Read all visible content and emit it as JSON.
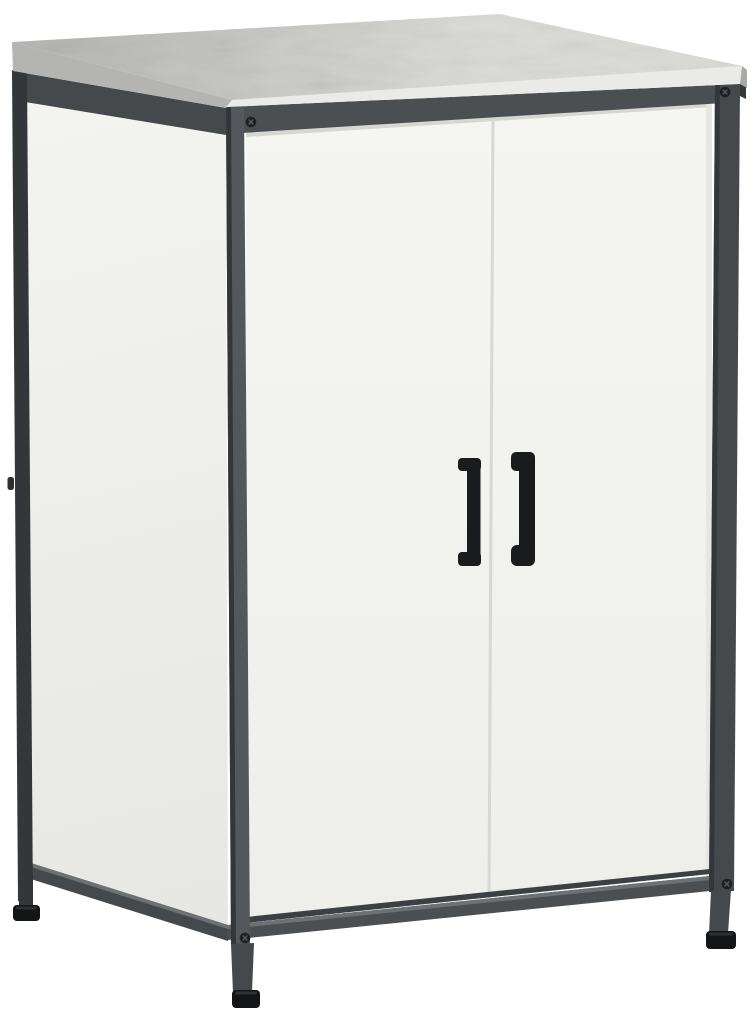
{
  "scene": {
    "description": "Product photo of a two-door storage cabinet with an anthracite metal frame, white side panel and doors, gray board top, black bar handles and adjustable feet",
    "view": "front-left three-quarter view on plain white background",
    "parts": [
      "top-panel",
      "frame",
      "left-side-panel",
      "left-door",
      "right-door",
      "door-handles",
      "corner-screws",
      "adjustable-feet"
    ]
  },
  "colors": {
    "background": "#ffffff",
    "slab_top_dark": "#b2b2b0",
    "slab_top_light": "#dadad7",
    "slab_side": "#b4b4b2",
    "slab_front": "#eaeae8",
    "slab_edge": "#a9a9a7",
    "frame_dark": "#46494c",
    "frame_front": "#4c4f52",
    "frame_post_lit": "#54575b",
    "frame_edge_dark": "#34373a",
    "rail_top_light": "#6e7174",
    "end_cap": "#35383b",
    "side_panel_light": "#f3f3ef",
    "side_panel_dark": "#e7e7e3",
    "door_light": "#f5f5f1",
    "door_dark": "#eeeeea",
    "door_top_shadow": "#d7d7d2",
    "door_bottom_shadow": "#3d4043",
    "door_gap": "#d8d8d3",
    "door_edge_shadow": "#e6e6e2",
    "handle": "#1a1b1d",
    "foot_black": "#131415",
    "foot_highlight": "#2e3032",
    "screw": "#1d1f21",
    "screw_slot": "#585b5e",
    "nub": "#2b2d30"
  }
}
